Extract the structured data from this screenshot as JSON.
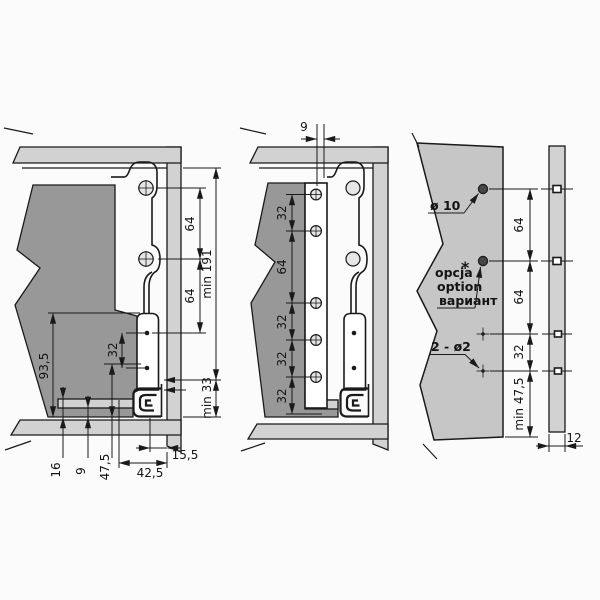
{
  "figure": {
    "type": "technical drawing",
    "subject": "Drawer slide side-section installation dimensions: two section views, mounting panel hole pattern and panel edge view"
  },
  "views": {
    "left": {
      "dims": {
        "hole_spacing_top": "64",
        "hole_spacing_mid": "64",
        "min_height": "min 191",
        "back_height": "93,5",
        "rivet_spacing": "32",
        "bottom_16": "16",
        "bottom_9": "9",
        "bottom_47_5": "47,5",
        "depth_42_5": "42,5",
        "depth_15_5": "15,5",
        "min_bottom": "min 33"
      }
    },
    "middle": {
      "dims": {
        "front_offset": "9",
        "row1": "32",
        "row2": "64",
        "row3": "32",
        "row4": "32",
        "row5": "32"
      }
    },
    "right": {
      "labels": {
        "hole_diameter": "ø 10",
        "option_pl": "opcja",
        "option_en": "option",
        "option_ru": "вариант",
        "option_mark": "*",
        "small_holes": "2 - ø2"
      },
      "dims": {
        "spacing_top": "64",
        "spacing_mid": "64",
        "spacing_low": "32",
        "min_bottom": "min 47,5"
      }
    },
    "edge": {
      "dims": {
        "panel_thickness": "12"
      }
    }
  },
  "palette": {
    "background": "#fbfbfb",
    "cabinet_panel": "#d2d2d2",
    "wood_section": "#989898",
    "mount_panel": "#c6c6c6",
    "line": "#1a1a1a"
  }
}
